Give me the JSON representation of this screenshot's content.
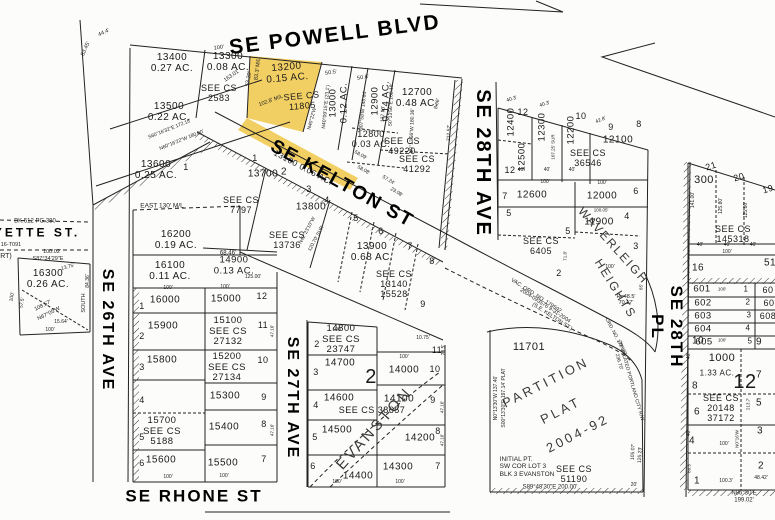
{
  "highlight_color": "#F2CF63",
  "streets": {
    "powell": "SE POWELL BLVD",
    "kelton": "SE KELTON ST",
    "ave26": "SE 26TH AVE",
    "ave27": "SE 27TH AVE",
    "ave28": "SE 28TH AVE",
    "pl28": "SE 28TH PL",
    "rhone": "SE RHONE ST",
    "lafayette_partial": "YETTE ST.",
    "lafayette_cut": "RT)"
  },
  "plats": {
    "evanston": "EVANSTON",
    "waverleigh": "WAVERLEIGH",
    "heights": "HEIGHTS",
    "partition1": "PARTITION",
    "partition2": "PLAT",
    "partition3": "2004-92",
    "vac1": "VAC. ORD. NO. 179592",
    "vac2": "2004-093576  9-31-2004",
    "vac3": "(S.E. KELTON ST.)",
    "ord178": "ORD. NO. 178592",
    "vacport": "20' VACATED PORTLAND CITY R/W",
    "initial": "INITIAL PT.\nSW COR LOT 3\nBLK 3 EVANSTON"
  },
  "parcels": {
    "p13400": "13400\n0.27 AC.",
    "p13300": "13300\n0.08 AC.",
    "p13200": "13200\n0.15 AC.",
    "p13100": "13100  0.06 AC.",
    "p13000": "13000\n0.12 AC.",
    "p12900": "12900\n0.14 AC.",
    "p12800": "12800\n0.03 AC.",
    "p12700": "12700\n0.48 AC.",
    "p13500": "13500\n0.22 AC.",
    "p13600": "13600\n0.25 AC.",
    "p13700": "13700",
    "p13800": "13800",
    "p13900": "13900\n0.68 AC.",
    "p14900": "14900\n0.13 AC.",
    "p16200": "16200\n0.19 AC.",
    "p16100": "16100\n0.11 AC.",
    "p16300": "16300\n0.26 AC.",
    "p16000": "16000",
    "p15900": "15900",
    "p15800": "15800",
    "p15700": "15700\nSEE CS\n5188",
    "p15600": "15600",
    "p15000": "15000",
    "p15100": "15100\nSEE CS\n27132",
    "p15200": "15200\nSEE CS\n27134",
    "p15300": "15300",
    "p15400": "15400",
    "p15500": "15500",
    "p14800": "14800\nSEE CS\n23747",
    "p14700": "14700",
    "p14600": "14600",
    "p14500": "14500",
    "p14400": "14400",
    "p14000": "14000",
    "p14100": "14100",
    "p14200": "14200",
    "p14300": "14300",
    "p12400": "12400",
    "p12300": "12300",
    "p12200": "12200",
    "p12100": "12100",
    "p12500": "12500",
    "p12600": "12600",
    "p12000": "12000",
    "p11900": "11900",
    "p11701": "11701",
    "p300": "300",
    "p1000": "1000",
    "ac1000": "1.33 AC.",
    "p601": "601",
    "p602": "602",
    "p603": "603",
    "p604": "604",
    "p605": "605",
    "p608": "608",
    "p60": "60"
  },
  "cs": {
    "c2583": "SEE CS\n2583",
    "c11805": "SEE CS\n11805",
    "c7797": "SEE CS\n7797",
    "c13736": "SEE CS\n13736",
    "c13140": "SEE CS\n13140\n15528",
    "c49220": "SEE CS\n49220",
    "c41292": "SEE CS\n41292",
    "c36546": "SEE CS\n36546",
    "c6405": "SEE CS\n6405",
    "c38657": "SEE CS 38657",
    "c51190": "SEE CS\n51190",
    "c145318": "SEE CS 145318",
    "c20148": "SEE CS\n20148\n37172"
  },
  "lots": {
    "n1": "1",
    "n2": "2",
    "n3": "3",
    "n4": "4",
    "n5": "5",
    "n6": "6",
    "n7": "7",
    "n8": "8",
    "n9": "9",
    "n10": "10",
    "n11": "11",
    "n12": "12",
    "n16": "16",
    "n19": "19",
    "n20": "20",
    "n21": "21",
    "n51": "51"
  },
  "dims": {
    "d44_4": "44.4'",
    "d53_45": "53.45'",
    "d100": "100'",
    "d163": "163.01'",
    "d53_20": "53.20'",
    "d83_3": "83.3' M/L",
    "d102_8": "102.8' M/L",
    "d50_5": "50.5'",
    "d50_6": "50.6'",
    "dn4009": "N40°09'15\"E (23.1')",
    "dn0758": "N07°58'W 145.64'",
    "d137": "137.93'",
    "ds013": "S0°13'56\"E 168.18'",
    "dn013": "N0°13'56\"W 180.36'",
    "d8_66": "8.66'",
    "d212": "212.52'",
    "d58_09": "58.09'",
    "d58_08": "58.08'",
    "d57_24": "57.24'",
    "d23_08": "23.08'",
    "dn4022": "N40°22'W",
    "ds60": "S60°16'32\"E 172.18'",
    "dn60": "N60°16'22\"W 180.00'",
    "d125": "125.00'",
    "dn4223": "N42°23'10\"W",
    "d120_70": "120.70' SUR",
    "d68": "68.46'",
    "deast": "EAST  130'  M/L",
    "d100_02": "100.02'",
    "ds87": "S87°34'29\"E",
    "d13_75": "13.75'",
    "dsouth": "SOUTH",
    "d84_36": "84.36'",
    "d108": "108.57'",
    "dn67": "N67°05'W",
    "d15_64": "15.64'",
    "d57_5": "57.5'",
    "dbk": "BK.512 PG.380",
    "d16t": "16-T091",
    "d47_16": "47.16'",
    "d10_75": "10.75'",
    "d28_5": "28.5'",
    "d40_3": "40.3'",
    "d42_8": "42.8'",
    "d107_25": "107.25' SUR",
    "d40": "40'",
    "d100_05": "100.05'",
    "d71_8": "71.8'",
    "d85": "85'",
    "dr48": "R=48.5'\n70.17'",
    "d236": "236.70'",
    "dn013b": "N0°13'30\"W 137.46'",
    "ds0013": "S00°13'30\"E 197.14' PLAT",
    "d105": "105.07'",
    "d125_23": "125.23'",
    "d20": "20'",
    "ds8948": "S89°48'30\"E   200.00'",
    "d141": "141.00'",
    "d125_80": "125.80'",
    "d213_7": "213.7'",
    "dn016": "N0°16'W",
    "d60_5": "60.5'",
    "d100_3": "100.3'",
    "d48_42": "48.42'",
    "dn8630": "N86°30'E  199.02'"
  }
}
